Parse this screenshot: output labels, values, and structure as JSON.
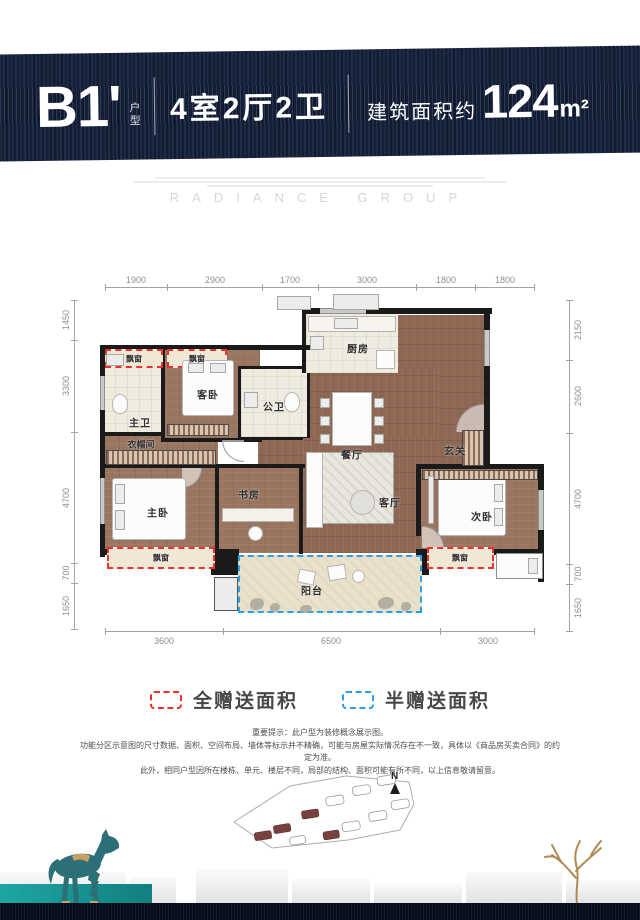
{
  "header": {
    "unit": "B1'",
    "unit_tag": "户型",
    "layout": "4室2厅2卫",
    "area_prefix": "建筑面积约",
    "area_value": "124",
    "area_unit": "m²"
  },
  "watermark": "RADIANCE GROUP",
  "plan": {
    "dims_top": [
      "1900",
      "2900",
      "1700",
      "3000",
      "1800",
      "1800"
    ],
    "dims_left": [
      "1450",
      "3300",
      "4700",
      "700",
      "1650"
    ],
    "dims_right": [
      "2150",
      "2600",
      "4700",
      "700",
      "1650"
    ],
    "dims_bottom": [
      "3600",
      "6500",
      "3000"
    ],
    "rooms": {
      "bay": "飘窗",
      "master_bath": "主卫",
      "guest_bed": "客卧",
      "public_bath": "公卫",
      "kitchen": "厨房",
      "dining": "餐厅",
      "foyer": "玄关",
      "cloak": "衣帽间",
      "master_bed": "主卧",
      "study": "书房",
      "living": "客厅",
      "second_bed": "次卧",
      "balcony": "阳台"
    }
  },
  "legend": {
    "full": "全赠送面积",
    "half": "半赠送面积",
    "full_color": "#e8322e",
    "half_color": "#2aa0ea"
  },
  "disclaimer": {
    "line1": "重要提示：此户型为装修概念展示图。",
    "line2": "功能分区示意图的尺寸数据、面积、空间布局、墙体等标示并不精确，可能与房屋实际情况存在不一致，具体以《商品房买卖合同》的约定为准。",
    "line3": "此外，相同户型因所在楼栋、单元、楼层不同，局部的结构、面积可能有所不同，以上信息敬请留意。"
  },
  "siteplan": {
    "north": "N"
  }
}
